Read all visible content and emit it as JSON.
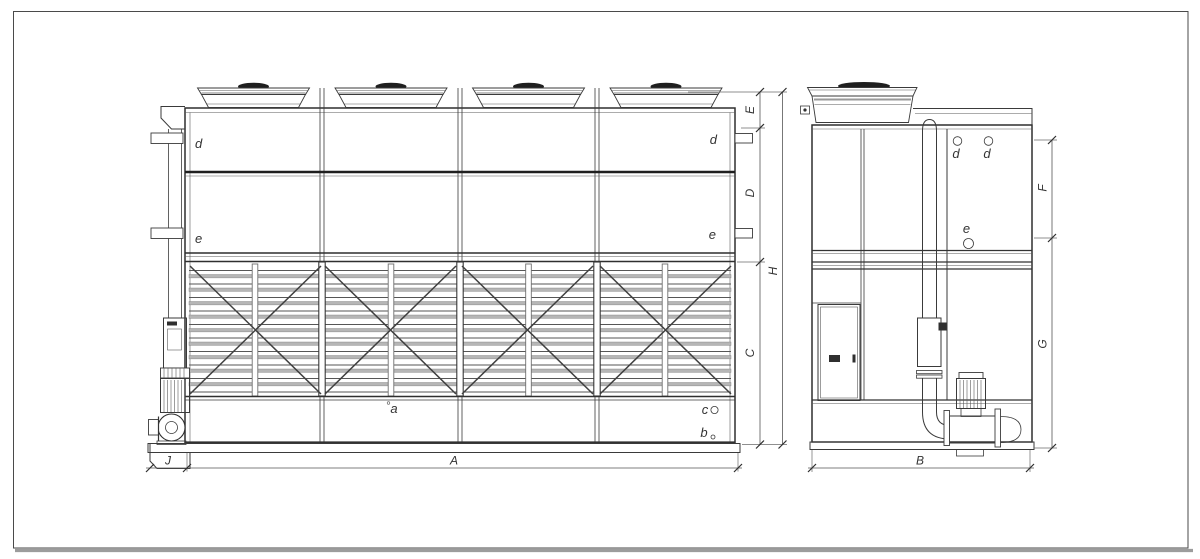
{
  "colors": {
    "line": "#3a3a3a",
    "slat_fill": "#b6b6b6",
    "fan_cap": "#1f1f1f",
    "frame_shadow": "#9c9c9c",
    "background": "#ffffff"
  },
  "front_view": {
    "labels": {
      "d_left": "d",
      "d_right": "d",
      "e_left": "e",
      "e_right": "e",
      "a": "a",
      "b": "b",
      "c": "c"
    },
    "dims": {
      "E": "E",
      "D": "D",
      "H": "H",
      "C": "C",
      "A": "A",
      "J": "J"
    }
  },
  "side_view": {
    "labels": {
      "d1": "d",
      "d2": "d",
      "e": "e"
    },
    "dims": {
      "F": "F",
      "G": "G",
      "B": "B"
    }
  }
}
